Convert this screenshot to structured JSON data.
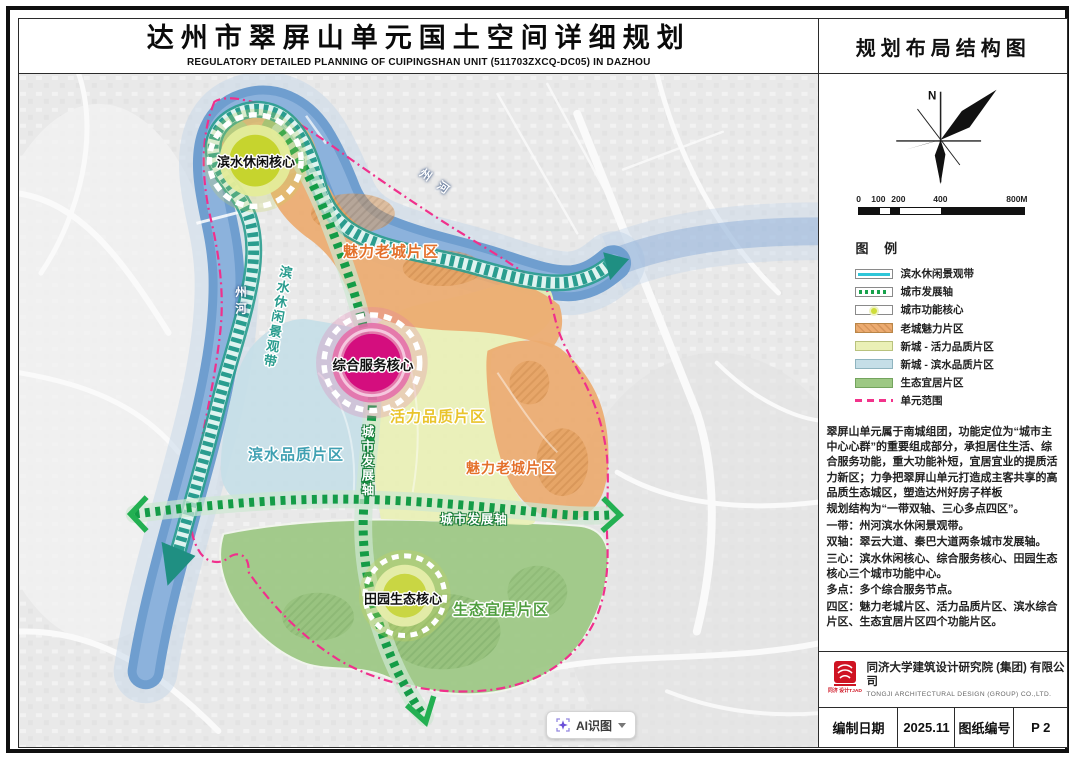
{
  "header": {
    "title_cn": "达州市翠屏山单元国土空间详细规划",
    "title_en": "REGULATORY DETAILED PLANNING OF CUIPINGSHAN UNIT (511703ZXCQ-DC05) IN DAZHOU"
  },
  "map": {
    "labels": {
      "riverside_core": "滨水休闲核心",
      "old_town_a": "魅力老城片区",
      "service_core": "综合服务核心",
      "vitality_zone": "活力品质片区",
      "waterfront_zone": "滨水品质片区",
      "old_town_b": "魅力老城片区",
      "eco_zone": "生态宜居片区",
      "rural_core": "田园生态核心",
      "axis_horizontal": "城市发展轴",
      "axis_vertical": "城市发展轴",
      "waterfront_belt": "滨水休闲景观带",
      "river_left": "州河",
      "river_top": "州河"
    },
    "ai_button": {
      "label": "AI识图"
    },
    "colors": {
      "river": "#6f9ecf",
      "belt_teal": "#2a9d8f",
      "axis_green": "#149c47",
      "old_town_fill": "#ecab70",
      "vitality_fill": "#eaf0b6",
      "waterfront_fill": "#c5dee7",
      "eco_fill": "#9dc884",
      "core_magenta": "#d40e7e",
      "core_yellowgreen": "#c9d643",
      "unit_boundary_pink": "#f0308c"
    }
  },
  "panel": {
    "map_name": "规划布局结构图",
    "north_label": "N",
    "scale": {
      "ticks": [
        "0",
        "100",
        "200",
        "400",
        "800M"
      ]
    },
    "legend": {
      "title": "图  例",
      "items": [
        {
          "label": "滨水休闲景观带"
        },
        {
          "label": "城市发展轴"
        },
        {
          "label": "城市功能核心"
        },
        {
          "label": "老城魅力片区"
        },
        {
          "label": "新城 - 活力品质片区"
        },
        {
          "label": "新城 - 滨水品质片区"
        },
        {
          "label": "生态宜居片区"
        },
        {
          "label": "单元范围"
        }
      ]
    },
    "description": [
      "翠屏山单元属于南城组团，功能定位为“城市主中心心群”的重要组成部分，承担居住生活、综合服务功能，重大功能补短，宜居宜业的提质活力新区；力争把翠屏山单元打造成主客共享的高品质生态城区，塑造达州好房子样板",
      "规划结构为“一带双轴、三心多点四区”。",
      "一带：州河滨水休闲景观带。",
      "双轴：翠云大道、秦巴大道两条城市发展轴。",
      "三心：滨水休闲核心、综合服务核心、田园生态核心三个城市功能中心。",
      "多点：多个综合服务节点。",
      "四区：魅力老城片区、活力品质片区、滨水综合片区、生态宜居片区四个功能片区。"
    ],
    "firm": {
      "name_cn": "同济大学建筑设计研究院 (集团) 有限公司",
      "name_en": "TONGJI ARCHITECTURAL DESIGN (GROUP) CO.,LTD.",
      "logo_text": "同济 设计TJAD"
    },
    "info": {
      "date_label": "编制日期",
      "date_value": "2025.11",
      "sheet_label": "图纸编号",
      "sheet_value": "P 2"
    }
  }
}
